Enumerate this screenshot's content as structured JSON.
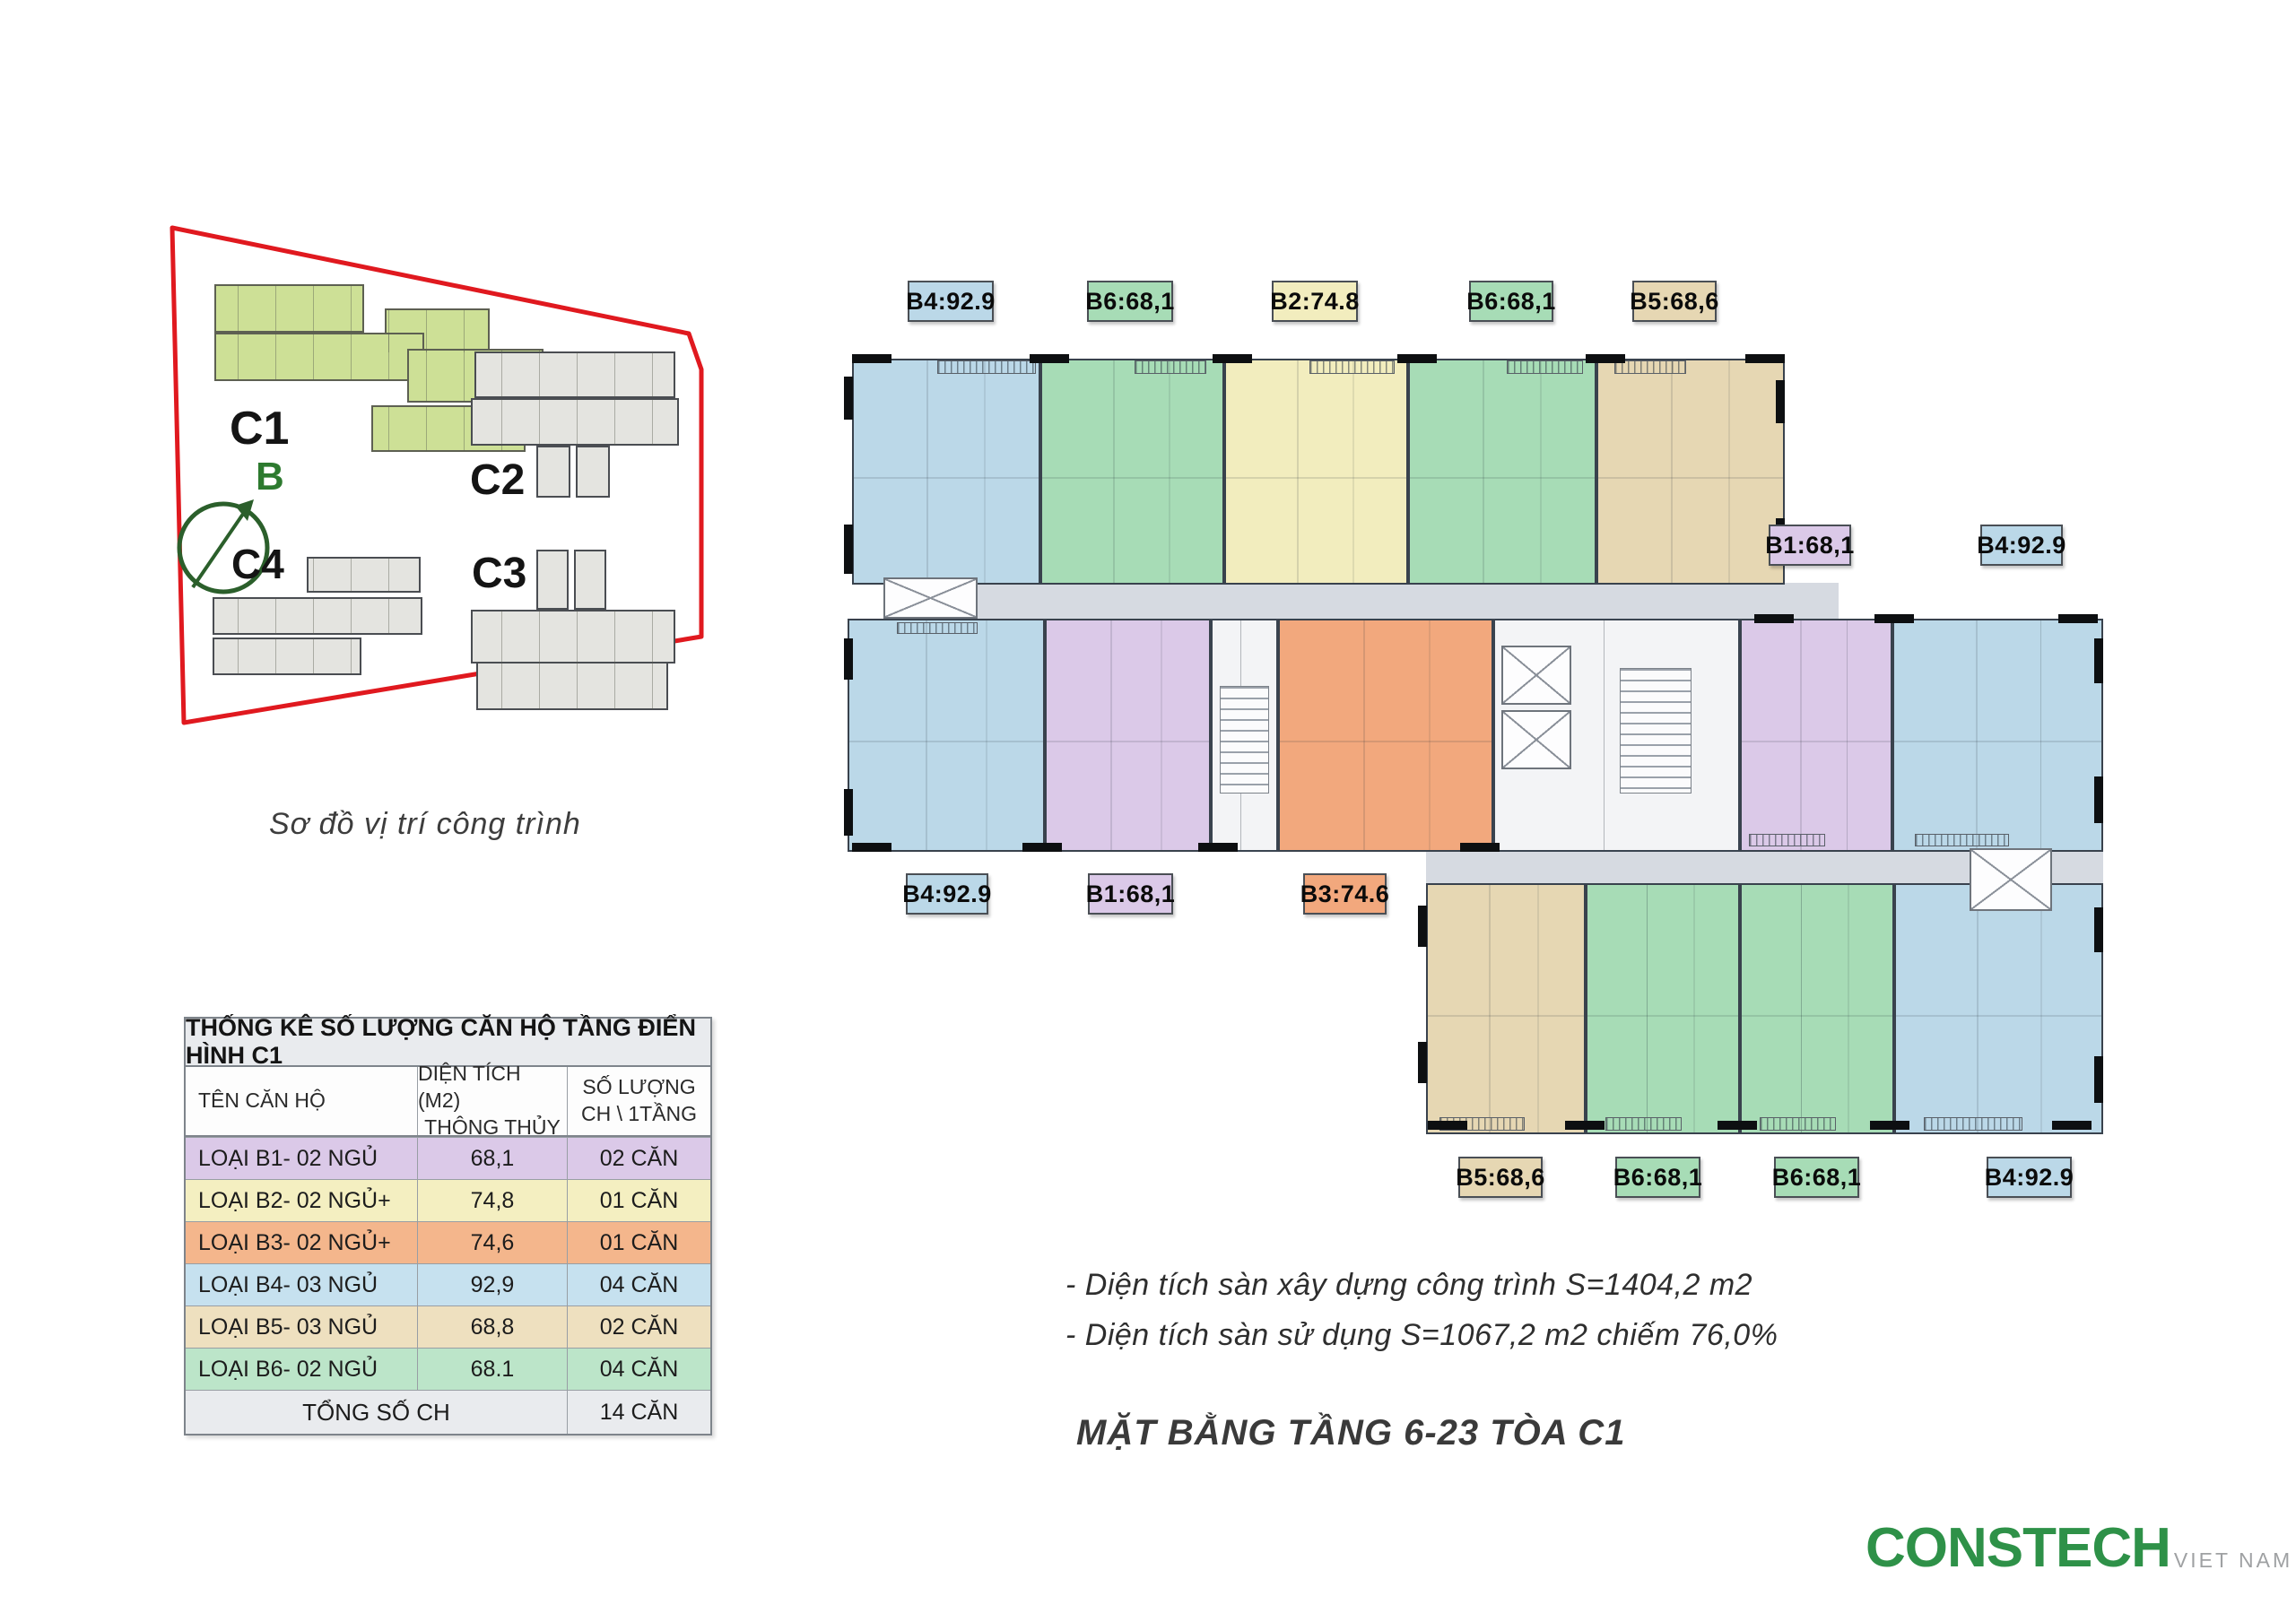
{
  "site_diagram": {
    "caption": "Sơ đồ vị trí công trình",
    "compass_label": "B",
    "buildings": [
      {
        "id": "C1",
        "highlighted": true
      },
      {
        "id": "C2",
        "highlighted": false
      },
      {
        "id": "C3",
        "highlighted": false
      },
      {
        "id": "C4",
        "highlighted": false
      }
    ],
    "colors": {
      "highlight_building": "#cde096",
      "other_building": "#e4e4e0",
      "boundary": "#e0191f",
      "compass": "#2b5f2b",
      "north_label": "#2d7a2f"
    }
  },
  "table": {
    "title": "THỐNG KÊ SỐ LƯỢNG CĂN HỘ TẦNG ĐIỂN HÌNH C1",
    "header_bg": "#e9ebee",
    "headers": {
      "name": "TÊN CĂN HỘ",
      "area_line1": "DIỆN TÍCH (M2)",
      "area_line2": "THÔNG THỦY",
      "qty_line1": "SỐ LƯỢNG",
      "qty_line2": "CH \\ 1TẦNG"
    },
    "rows": [
      {
        "name": "LOẠI B1- 02 NGỦ",
        "area": "68,1",
        "qty": "02 CĂN",
        "color": "#dbc9e8"
      },
      {
        "name": "LOẠI B2- 02 NGỦ+",
        "area": "74,8",
        "qty": "01 CĂN",
        "color": "#f4efc1"
      },
      {
        "name": "LOẠI B3- 02 NGỦ+",
        "area": "74,6",
        "qty": "01 CĂN",
        "color": "#f4b68c"
      },
      {
        "name": "LOẠI B4- 03 NGỦ",
        "area": "92,9",
        "qty": "04 CĂN",
        "color": "#c6e1ef"
      },
      {
        "name": "LOẠI B5- 03 NGỦ",
        "area": "68,8",
        "qty": "02 CĂN",
        "color": "#eee0bf"
      },
      {
        "name": "LOẠI B6- 02 NGỦ",
        "area": "68.1",
        "qty": "04 CĂN",
        "color": "#bce5c9"
      }
    ],
    "total": {
      "label": "TỔNG SỐ CH",
      "qty": "14 CĂN"
    }
  },
  "floor_plan": {
    "unit_colors": {
      "B1": "#dbc9e8",
      "B2": "#f2edbe",
      "B3": "#f2a87d",
      "B4": "#bbd8e8",
      "B5": "#e6d7b3",
      "B6": "#a7dcb6"
    },
    "unit_labels": {
      "top": [
        {
          "text": "B4:92.9",
          "color": "#bbd8e8"
        },
        {
          "text": "B6:68,1",
          "color": "#a7dcb6"
        },
        {
          "text": "B2:74.8",
          "color": "#f2edbe"
        },
        {
          "text": "B6:68,1",
          "color": "#a7dcb6"
        },
        {
          "text": "B5:68,6",
          "color": "#e6d7b3"
        }
      ],
      "mid_right": [
        {
          "text": "B1:68,1",
          "color": "#dbc9e8"
        },
        {
          "text": "B4:92.9",
          "color": "#bbd8e8"
        }
      ],
      "mid_left": [
        {
          "text": "B4:92.9",
          "color": "#bbd8e8"
        },
        {
          "text": "B1:68,1",
          "color": "#dbc9e8"
        },
        {
          "text": "B3:74.6",
          "color": "#f2a87d"
        }
      ],
      "bottom": [
        {
          "text": "B5:68,6",
          "color": "#e6d7b3"
        },
        {
          "text": "B6:68,1",
          "color": "#a7dcb6"
        },
        {
          "text": "B6:68,1",
          "color": "#a7dcb6"
        },
        {
          "text": "B4:92.9",
          "color": "#bbd8e8"
        }
      ]
    }
  },
  "notes": [
    "- Diện tích sàn xây dựng công trình S=1404,2 m2",
    "- Diện tích sàn sử dụng S=1067,2 m2 chiếm 76,0%"
  ],
  "main_title": "MẶT BẰNG TẦNG 6-23 TÒA C1",
  "logo": {
    "brand": "CONSTECH",
    "region": "VIET NAM",
    "brand_color": "#2e9148",
    "region_color": "#9fa1a3"
  }
}
